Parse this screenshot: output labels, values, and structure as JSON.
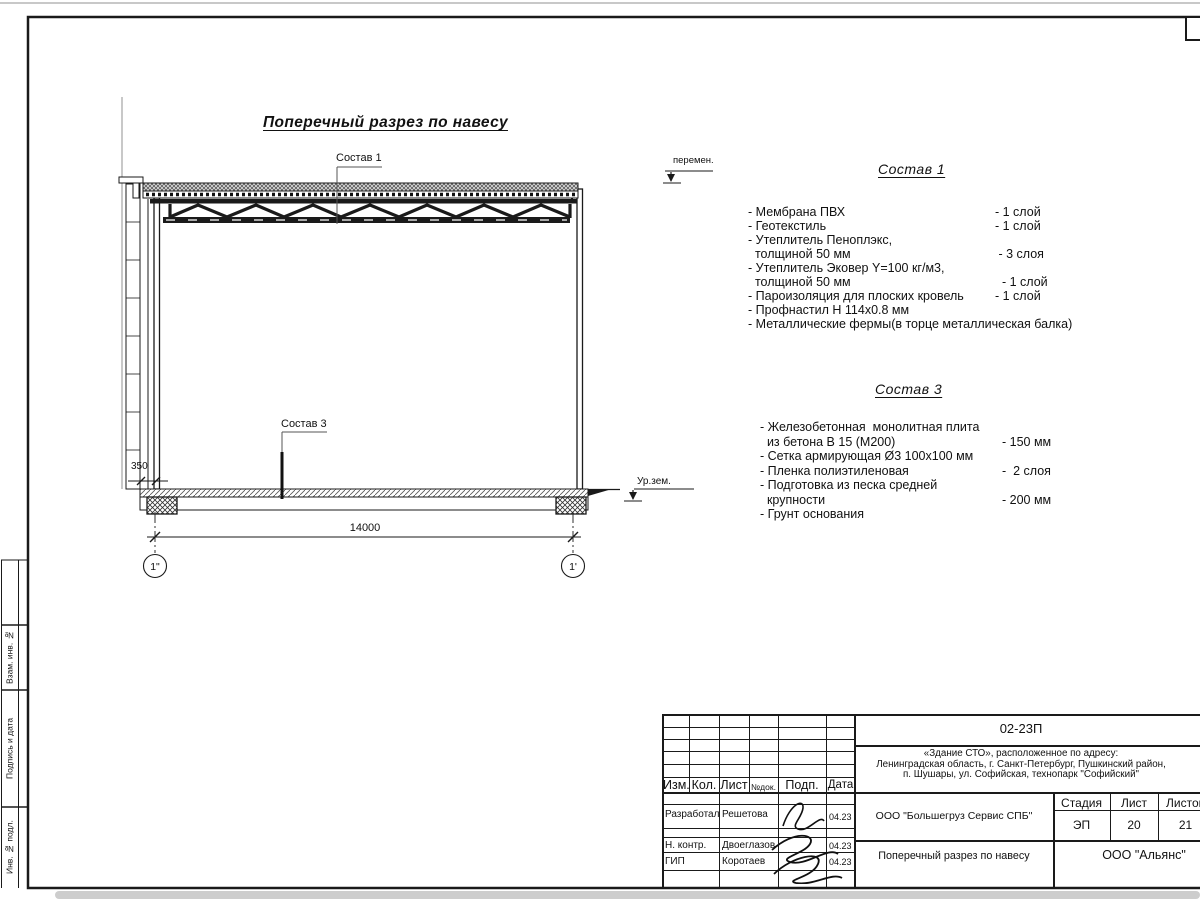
{
  "sheet": {
    "drawing_title": "Поперечный разрез по навесу",
    "callouts": {
      "roof": "Состав 1",
      "floor": "Состав 3"
    },
    "dimensions": {
      "span": "14000",
      "offset": "350"
    },
    "axes": {
      "left": "1\"",
      "right": "1'"
    },
    "levels": {
      "variable": "перемен.",
      "ground": "Ур.зем."
    }
  },
  "spec_roof": {
    "title": "Состав 1",
    "items": [
      {
        "text": "- Мембрана ПВХ",
        "qty": "- 1 слой"
      },
      {
        "text": "- Геотекстиль",
        "qty": "- 1 слой"
      },
      {
        "text": "- Утеплитель Пеноплэкс,",
        "qty": ""
      },
      {
        "text": "  толщиной 50 мм",
        "qty": " - 3 слоя"
      },
      {
        "text": "- Утеплитель Эковер Y=100 кг/м3,",
        "qty": ""
      },
      {
        "text": "  толщиной 50 мм",
        "qty": "  - 1 слой"
      },
      {
        "text": "- Пароизоляция для плоских кровель",
        "qty": "- 1 слой"
      },
      {
        "text": "- Профнастил Н 114х0.8 мм",
        "qty": ""
      },
      {
        "text": "- Металлические фермы(в торце металлическая балка)",
        "qty": ""
      }
    ]
  },
  "spec_floor": {
    "title": "Состав 3",
    "items": [
      {
        "text": "- Железобетонная  монолитная плита",
        "qty": ""
      },
      {
        "text": "  из бетона В 15 (М200)",
        "qty": "- 150 мм"
      },
      {
        "text": "- Сетка армирующая Ø3 100х100 мм",
        "qty": ""
      },
      {
        "text": "- Пленка полиэтиленовая",
        "qty": "-  2 слоя"
      },
      {
        "text": "- Подготовка из песка средней",
        "qty": ""
      },
      {
        "text": "  крупности",
        "qty": "- 200 мм"
      },
      {
        "text": "- Грунт основания",
        "qty": ""
      }
    ]
  },
  "title_block": {
    "doc_number": "02-23П",
    "object_address": [
      "«Здание СТО», расположенное по адресу:",
      "Ленинградская область, г. Санкт-Петербург, Пушкинский район,",
      "п. Шушары, ул. Софийская, технопарк \"Софийский\""
    ],
    "client_org": "ООО \"Большегруз Сервис СПБ\"",
    "sheet_name": "Поперечный разрез по навесу",
    "design_org": "ООО \"Альянс\"",
    "columns": {
      "izm": "Изм.",
      "kol": "Кол.",
      "list": "Лист",
      "doc_no": "№док.",
      "sign": "Подп.",
      "date": "Дата"
    },
    "stage": {
      "header": "Стадия",
      "value": "ЭП"
    },
    "sheet_no": {
      "header": "Лист",
      "value": "20"
    },
    "sheets_total": {
      "header": "Листов",
      "value": "21"
    },
    "staff": [
      {
        "role": "Разработал",
        "name": "Решетова",
        "date": "04.23"
      },
      {
        "role": "Н. контр.",
        "name": "Двоеглазов",
        "date": "04.23"
      },
      {
        "role": "ГИП",
        "name": "Коротаев",
        "date": "04.23"
      }
    ]
  },
  "margin_column": {
    "cells": [
      "Взам. инв. №",
      "Подпись и дата",
      "Инв. № подл."
    ]
  }
}
